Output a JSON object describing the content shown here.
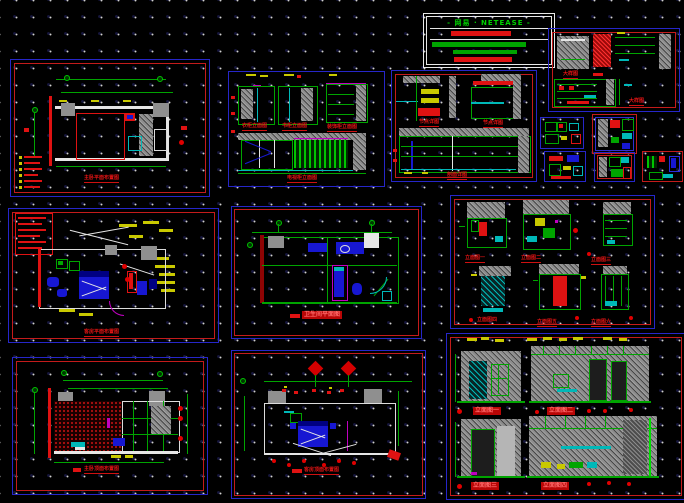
{
  "canvas": {
    "background": "#000000",
    "grid_dot_color": "#d2d2d2",
    "grid_spacing_px": 17
  },
  "palette": {
    "frame_blue": "#2626c9",
    "frame_red": "#c41b1b",
    "green": "#00a400",
    "cyan": "#00b8b8",
    "red": "#df1212",
    "yellow": "#c9c900",
    "magenta": "#c000c0",
    "gray": "#8f8f8f",
    "blue": "#1717d2",
    "white": "#e6e6e6"
  },
  "title_block": {
    "title": "- 网易 · NETEASE -"
  },
  "sheets": [
    {
      "id": "plan-top-left",
      "caption": "主卧平面布置图"
    },
    {
      "id": "elevations-top-middle",
      "captions": [
        "衣柜立面图",
        "书柜立面图",
        "装饰柜立面图",
        "电视柜立面图"
      ]
    },
    {
      "id": "details-top-center",
      "captions": [
        "节点详图",
        "节点详图",
        "剖面详图"
      ]
    },
    {
      "id": "details-top-right",
      "captions": [
        "大样图",
        "大样图"
      ]
    },
    {
      "id": "detail-a"
    },
    {
      "id": "detail-b"
    },
    {
      "id": "detail-c"
    },
    {
      "id": "detail-d"
    },
    {
      "id": "detail-e"
    },
    {
      "id": "plan-middle-left",
      "caption": "客房平面布置图"
    },
    {
      "id": "plan-middle-center",
      "caption": "卫生间平面图"
    },
    {
      "id": "elevations-middle-right",
      "captions": [
        "立面图一",
        "立面图二",
        "立面图三",
        "立面图四",
        "立面图五",
        "立面图六"
      ]
    },
    {
      "id": "ceiling-bottom-left",
      "caption": "主卧顶面布置图"
    },
    {
      "id": "ceiling-bottom-middle",
      "caption": "客房顶面布置图"
    },
    {
      "id": "elevations-bottom-right",
      "captions": [
        "立面图一",
        "立面图二",
        "立面图三",
        "立面图四"
      ]
    }
  ]
}
